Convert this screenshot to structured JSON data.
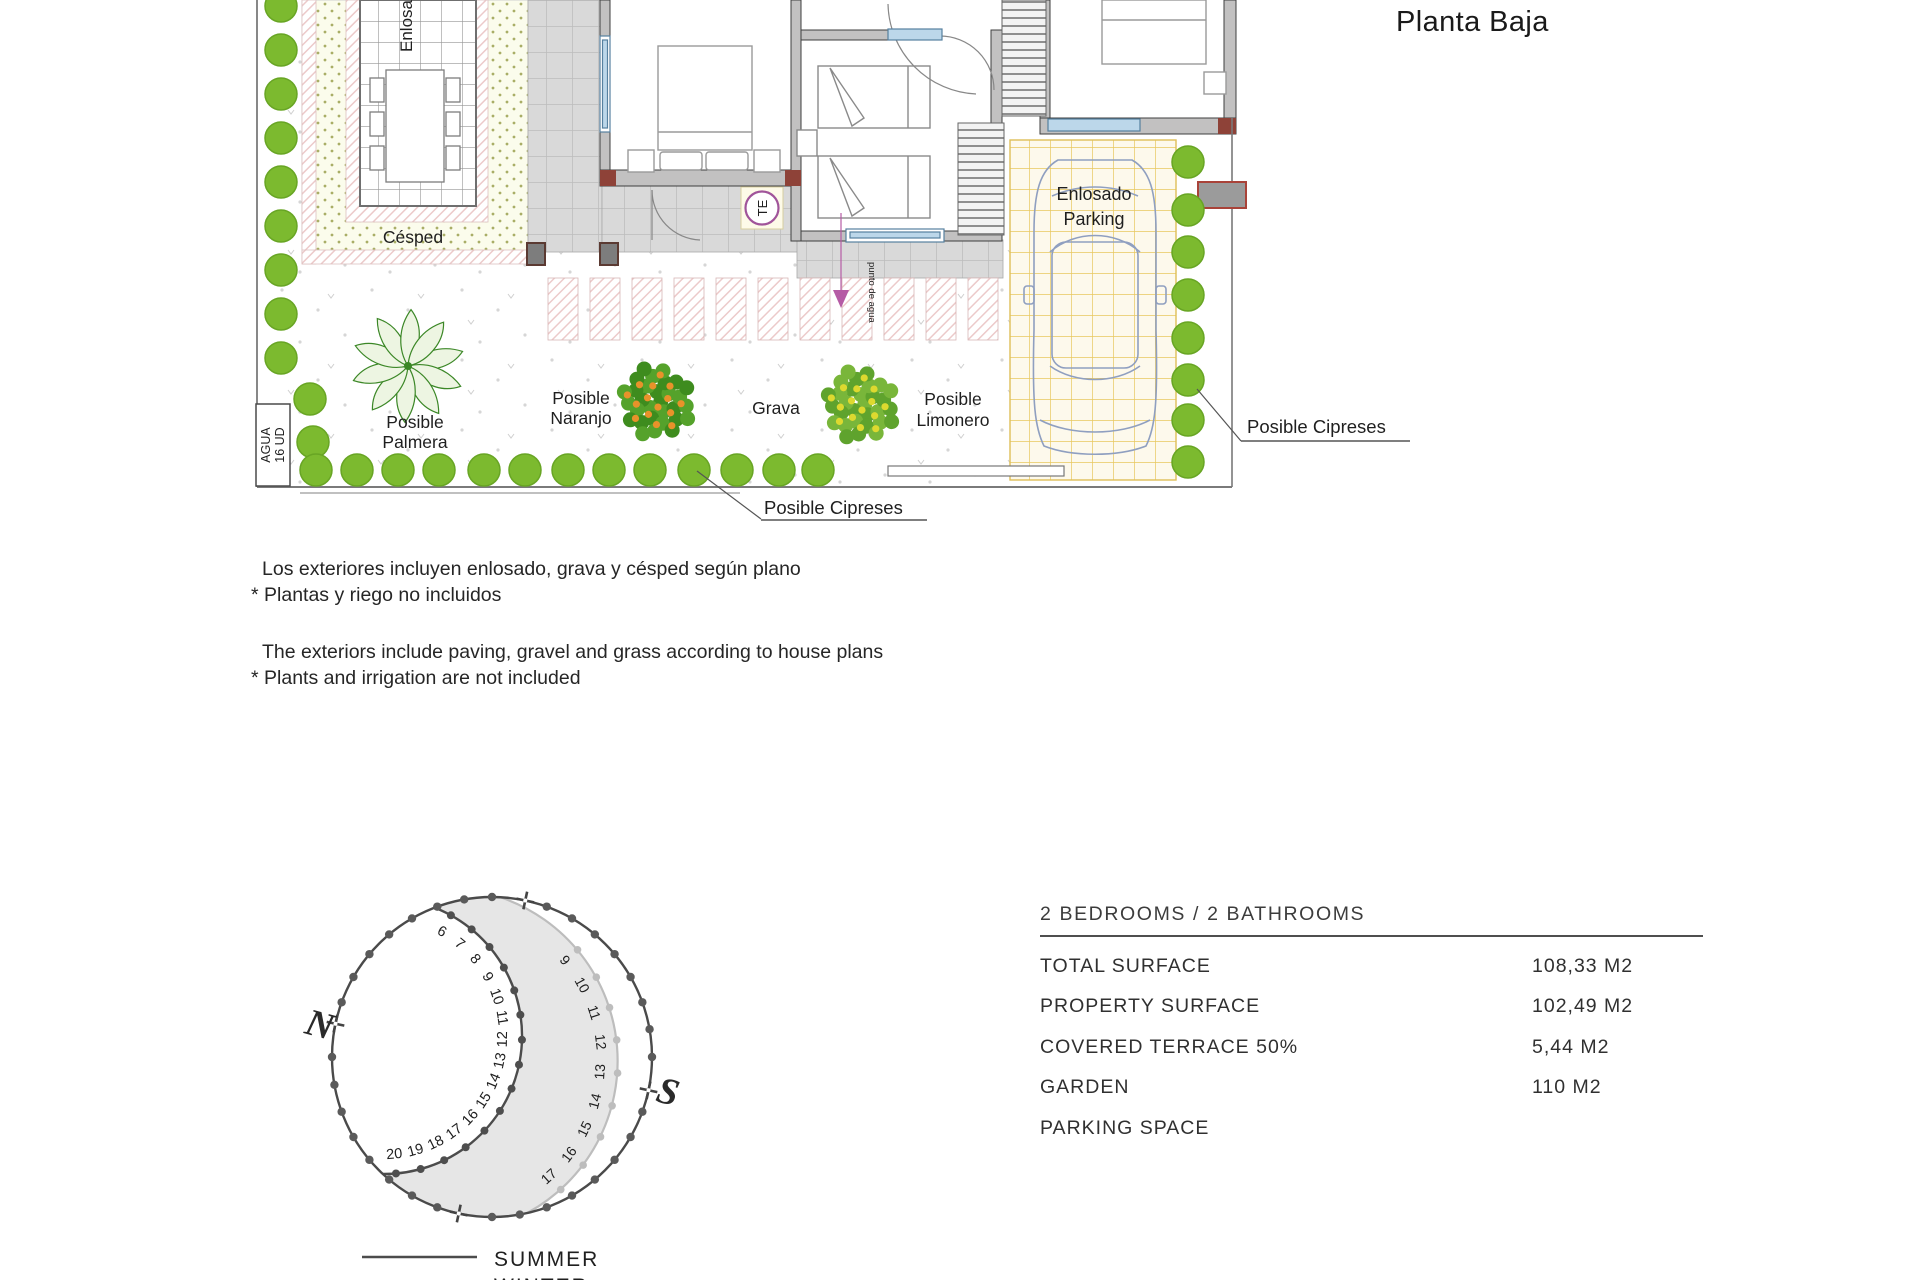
{
  "header": {
    "title": "Planta Baja"
  },
  "plan": {
    "labels": {
      "enlosado_top": "Enlosado",
      "cesped": "Césped",
      "palmera": [
        "Posible",
        "Palmera"
      ],
      "naranjo": [
        "Posible",
        "Naranjo"
      ],
      "grava": "Grava",
      "limonero": [
        "Posible",
        "Limonero"
      ],
      "parking": [
        "Enlosado",
        "Parking"
      ],
      "cipreses_bottom": "Posible Cipreses",
      "cipreses_right": "Posible Cipreses",
      "agua_line1": "AGUA",
      "agua_line2": "16 UD",
      "punto_agua": "punto de agua",
      "te_symbol": "TE"
    }
  },
  "notes": {
    "es": [
      "Los exteriores incluyen enlosado, grava y césped según plano",
      "* Plantas y riego no incluidos"
    ],
    "en": [
      "The exteriors include paving, gravel and grass according to house plans",
      "* Plants and irrigation are not included"
    ]
  },
  "sun_diagram": {
    "north_label": "N",
    "south_label": "S",
    "summer_hours": [
      6,
      7,
      8,
      9,
      10,
      11,
      12,
      13,
      14,
      15,
      16,
      17,
      18,
      19,
      20
    ],
    "winter_hours": [
      9,
      10,
      11,
      12,
      13,
      14,
      15,
      16,
      17
    ],
    "legend": [
      {
        "label": "SUMMER",
        "color": "#4c4c4c"
      },
      {
        "label": "WINTER",
        "color": "#b0b0b0"
      }
    ]
  },
  "specs": {
    "heading": "2 BEDROOMS / 2 BATHROOMS",
    "rows": [
      {
        "label": "TOTAL SURFACE",
        "value": "108,33 M2"
      },
      {
        "label": "PROPERTY SURFACE",
        "value": "102,49 M2"
      },
      {
        "label": "COVERED TERRACE 50%",
        "value": "5,44 M2"
      },
      {
        "label": "GARDEN",
        "value": "110 M2"
      },
      {
        "label": "PARKING SPACE",
        "value": ""
      }
    ]
  },
  "colors": {
    "cypress_green": "#7cba2f",
    "cypress_edge": "#68a524",
    "parking_grid": "#e8c75e",
    "hatch_pink": "#eccaca",
    "magenta": "#b55ba5",
    "wall_grey": "#c2c1c1",
    "accent_red": "#8e4238",
    "car_blue": "#8f9fc0",
    "summer_line": "#4c4c4c",
    "winter_line": "#bdbdbd"
  }
}
